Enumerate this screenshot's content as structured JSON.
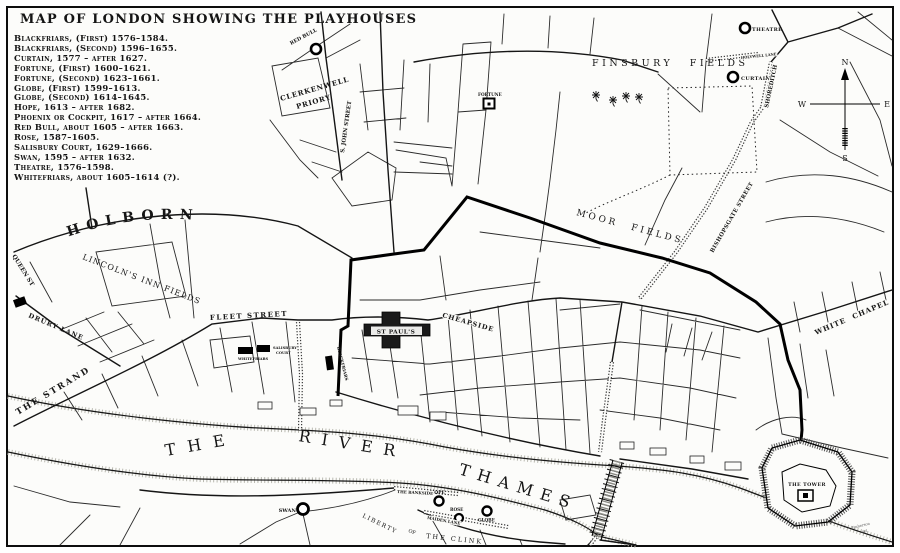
{
  "title": "MAP OF LONDON SHOWING THE PLAYHOUSES",
  "legend": {
    "items": [
      "Blackfriars, (First) 1576–1584.",
      "Blackfriars, (Second) 1596–1655.",
      "Curtain, 1577 – after 1627.",
      "Fortune, (First) 1600–1621.",
      "Fortune, (Second) 1623–1661.",
      "Globe, (First) 1599–1613.",
      "Globe, (Second) 1614–1645.",
      "Hope, 1613 – after 1682.",
      "Phoenix or Cockpit, 1617 – after 1664.",
      "Red Bull, about 1605 – after 1663.",
      "Rose, 1587–1605.",
      "Salisbury Court, 1629–1666.",
      "Swan, 1595 – after 1632.",
      "Theatre, 1576–1598.",
      "Whitefriars, about 1605–1614 (?)."
    ]
  },
  "streets": {
    "holborn": "HOLBORN",
    "queen_st": "QUEEN ST",
    "drury_lane": "DRURY LANE",
    "the_strand": "THE STRAND",
    "fleet_street": "FLEET STREET",
    "cheapside": "CHEAPSIDE",
    "st_john_street": "S. JOHN STREET",
    "bishopsgate_street": "BISHOPSGATE STREET",
    "shoreditch": "SHOREDITCH",
    "holywell_lane": "HOLYWELL LANE",
    "white_chapel": "WHITE CHAPEL",
    "the_bankside": "THE BANKSIDE",
    "maiden_lane": "MAIDEN LANE"
  },
  "areas": {
    "finsbury_fields": "FINSBURY  FIELDS",
    "moor_fields": "MOOR FIELDS",
    "lincolns_inn_fields": "LINCOLN'S INN FIELDS",
    "clerkenwell_line1": "CLERKENWELL",
    "clerkenwell_line2": "PRIORY",
    "liberty": "LIBERTY",
    "of": "OF",
    "the_clink": "THE  CLINK"
  },
  "river": {
    "the": "THE",
    "river": "RIVER",
    "thames": "THAMES"
  },
  "landmarks": {
    "st_pauls": "ST PAUL'S",
    "the_tower": "THE TOWER"
  },
  "playhouses": {
    "theatre": "THEATRE",
    "curtain": "CURTAIN",
    "red_bull": "RED BULL",
    "fortune": "FORTUNE",
    "swan": "SWAN",
    "hope": "HOPE",
    "rose": "ROSE",
    "globe": "GLOBE",
    "whitefriars": "WHITEFRIARS",
    "salisbury_line1": "SALISBURY",
    "salisbury_line2": "COURT",
    "blackfriars": "BLACKFRIARS"
  },
  "compass": {
    "n": "N",
    "e": "E",
    "s": "S",
    "w": "W"
  },
  "signature": {
    "line1": "Emberson",
    "line2": "del."
  }
}
